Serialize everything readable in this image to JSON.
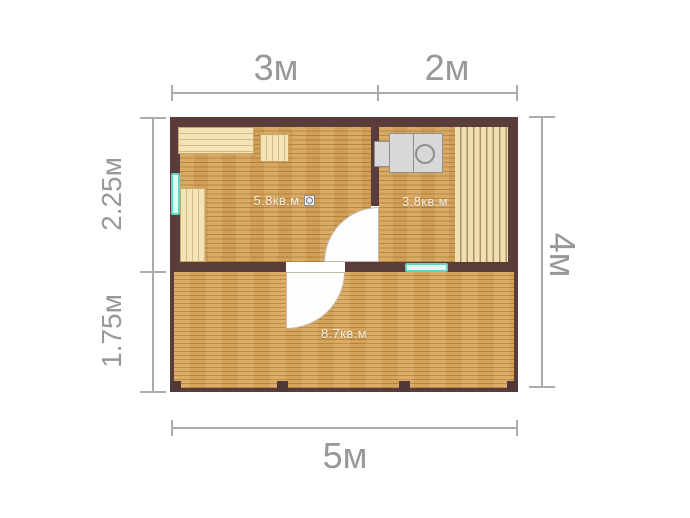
{
  "dimensions": {
    "top": {
      "segment1": "3м",
      "segment2": "2м"
    },
    "left": {
      "upper": "2.25м",
      "lower": "1.75м"
    },
    "right": {
      "total": "4м"
    },
    "bottom": {
      "total": "5м"
    }
  },
  "rooms": {
    "room1": {
      "area": "5.8кв.м"
    },
    "room2": {
      "area": "3.8кв.м"
    },
    "terrace": {
      "area": "8.7кв.м"
    }
  },
  "fixtures": {
    "stove": "sauna-stove",
    "vent_icon": "vent-icon",
    "window_count": 2,
    "door_count": 2
  },
  "colors": {
    "wall": "#5a3d3b",
    "floor": "#d7a65c",
    "floor_line": "#976529",
    "bench": "#f3e3b6",
    "bench_line": "#d6ba84",
    "window": "#63d3c4",
    "stove": "#d8d8d8",
    "stove_border": "#909090",
    "dimension_text": "#989898",
    "dimension_line": "#ababab",
    "room_label": "#f2ede4"
  }
}
